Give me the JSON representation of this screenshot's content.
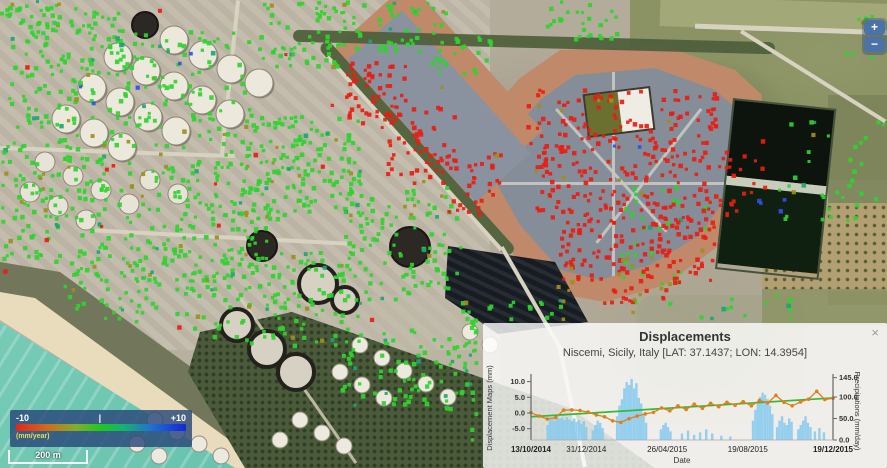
{
  "legend": {
    "min": "-10",
    "mid_tick": "|",
    "max": "+10",
    "units": "(mm/year)",
    "gradient": [
      "#e5261c 0%",
      "#d06a1e 18%",
      "#7fb02a 36%",
      "#1dc81d 50%",
      "#16b36e 63%",
      "#1e70d2 80%",
      "#1626d8 100%"
    ]
  },
  "scale_bar": {
    "label": "200 m"
  },
  "zoom_control": {
    "zoom_in": "+",
    "zoom_out": "−"
  },
  "popup": {
    "title": "Displacements",
    "subtitle": "Niscemi, Sicily, Italy [LAT: 37.1437; LON: 14.3954]",
    "close": "×"
  },
  "chart_data": {
    "type": "composite",
    "title": "Displacements",
    "subtitle": "Niscemi, Sicily, Italy [LAT: 37.1437; LON: 14.3954]",
    "x_axis": {
      "label": "Date",
      "tick_labels": [
        "13/10/2014",
        "31/12/2014",
        "26/04/2015",
        "19/08/2015",
        "19/12/2015"
      ],
      "tick_fracs": [
        0,
        0.183,
        0.451,
        0.718,
        1
      ]
    },
    "y_left": {
      "label": "Displacement Maps (mm)",
      "ticks": [
        10.0,
        5.0,
        0.0,
        -5.0
      ],
      "range": [
        -8.5,
        11.5
      ]
    },
    "y_right": {
      "label": "Precipitations (mm/day)",
      "ticks": [
        145.0,
        100.0,
        50.0,
        0.0
      ],
      "range": [
        0,
        160
      ]
    },
    "series": [
      {
        "name": "displacement",
        "type": "line",
        "color": "#e07f1e",
        "values": [
          0.1,
          -1.0,
          -1.9,
          -1.5,
          0.9,
          1.0,
          0.8,
          0.3,
          -0.6,
          -1.2,
          -2.5,
          -3.0,
          -1.8,
          -1.0,
          -0.3,
          0.2,
          1.6,
          0.7,
          2.3,
          1.1,
          2.8,
          1.5,
          3.1,
          2.0,
          3.4,
          2.5,
          3.6,
          2.3,
          4.0,
          3.2,
          5.6,
          3.4,
          2.3,
          3.5,
          4.4,
          6.9,
          4.3,
          4.7
        ]
      },
      {
        "name": "trend",
        "type": "line",
        "color": "#33bb33",
        "values": [
          -1.2,
          4.8
        ]
      },
      {
        "name": "precipitation",
        "type": "bar",
        "color": "#85c9ef",
        "points": [
          [
            0.055,
            35
          ],
          [
            0.063,
            48
          ],
          [
            0.071,
            52
          ],
          [
            0.079,
            45
          ],
          [
            0.087,
            55
          ],
          [
            0.095,
            50
          ],
          [
            0.103,
            52
          ],
          [
            0.111,
            47
          ],
          [
            0.119,
            53
          ],
          [
            0.127,
            48
          ],
          [
            0.135,
            44
          ],
          [
            0.143,
            50
          ],
          [
            0.151,
            42
          ],
          [
            0.159,
            46
          ],
          [
            0.167,
            38
          ],
          [
            0.175,
            44
          ],
          [
            0.183,
            30
          ],
          [
            0.205,
            22
          ],
          [
            0.213,
            35
          ],
          [
            0.221,
            45
          ],
          [
            0.229,
            40
          ],
          [
            0.237,
            28
          ],
          [
            0.285,
            55
          ],
          [
            0.293,
            80
          ],
          [
            0.301,
            95
          ],
          [
            0.309,
            120
          ],
          [
            0.317,
            135
          ],
          [
            0.325,
            128
          ],
          [
            0.333,
            142
          ],
          [
            0.341,
            120
          ],
          [
            0.349,
            132
          ],
          [
            0.357,
            98
          ],
          [
            0.365,
            85
          ],
          [
            0.373,
            60
          ],
          [
            0.381,
            40
          ],
          [
            0.43,
            25
          ],
          [
            0.438,
            35
          ],
          [
            0.446,
            40
          ],
          [
            0.454,
            30
          ],
          [
            0.462,
            20
          ],
          [
            0.5,
            15
          ],
          [
            0.52,
            22
          ],
          [
            0.54,
            12
          ],
          [
            0.56,
            18
          ],
          [
            0.58,
            25
          ],
          [
            0.6,
            15
          ],
          [
            0.63,
            10
          ],
          [
            0.66,
            8
          ],
          [
            0.735,
            45
          ],
          [
            0.743,
            70
          ],
          [
            0.751,
            85
          ],
          [
            0.759,
            100
          ],
          [
            0.767,
            110
          ],
          [
            0.775,
            105
          ],
          [
            0.783,
            95
          ],
          [
            0.791,
            80
          ],
          [
            0.799,
            60
          ],
          [
            0.815,
            30
          ],
          [
            0.823,
            45
          ],
          [
            0.831,
            55
          ],
          [
            0.839,
            40
          ],
          [
            0.847,
            35
          ],
          [
            0.855,
            50
          ],
          [
            0.863,
            42
          ],
          [
            0.885,
            25
          ],
          [
            0.893,
            35
          ],
          [
            0.901,
            45
          ],
          [
            0.909,
            55
          ],
          [
            0.917,
            40
          ],
          [
            0.925,
            30
          ],
          [
            0.94,
            20
          ],
          [
            0.955,
            28
          ],
          [
            0.97,
            18
          ]
        ]
      }
    ]
  },
  "map": {
    "markers": {
      "colors": {
        "green": "#2fd32f",
        "red": "#ea1c12",
        "olive": "#9c8f1c",
        "blue": "#2b50e8",
        "teal": "#1ba573"
      },
      "clusters": [
        [
          8,
          4,
          120,
          140,
          160,
          "green"
        ],
        [
          0,
          140,
          110,
          120,
          130,
          "green"
        ],
        [
          115,
          30,
          135,
          125,
          115,
          "green"
        ],
        [
          115,
          160,
          155,
          120,
          170,
          "green"
        ],
        [
          240,
          115,
          120,
          105,
          160,
          "green"
        ],
        [
          255,
          0,
          95,
          65,
          70,
          "green"
        ],
        [
          60,
          245,
          130,
          75,
          75,
          "green"
        ],
        [
          185,
          250,
          175,
          95,
          140,
          "green"
        ],
        [
          335,
          185,
          125,
          115,
          120,
          "green"
        ],
        [
          340,
          328,
          135,
          85,
          90,
          "green"
        ],
        [
          455,
          298,
          115,
          95,
          65,
          "green"
        ],
        [
          350,
          0,
          95,
          50,
          50,
          "green"
        ],
        [
          545,
          0,
          70,
          40,
          28,
          "green"
        ],
        [
          775,
          115,
          108,
          110,
          36,
          "green"
        ],
        [
          620,
          185,
          85,
          140,
          40,
          "green"
        ],
        [
          470,
          398,
          115,
          65,
          40,
          "green"
        ],
        [
          700,
          292,
          90,
          38,
          14,
          "green"
        ],
        [
          845,
          5,
          40,
          55,
          12,
          "green"
        ],
        [
          430,
          35,
          60,
          40,
          25,
          "green"
        ],
        [
          0,
          0,
          60,
          30,
          20,
          "green"
        ],
        [
          345,
          58,
          60,
          70,
          60,
          "red"
        ],
        [
          385,
          105,
          70,
          80,
          55,
          "red"
        ],
        [
          440,
          150,
          60,
          70,
          35,
          "red"
        ],
        [
          525,
          88,
          190,
          62,
          115,
          "red"
        ],
        [
          535,
          150,
          200,
          75,
          160,
          "red"
        ],
        [
          558,
          225,
          158,
          58,
          105,
          "red"
        ],
        [
          600,
          283,
          70,
          20,
          15,
          "red"
        ],
        [
          0,
          0,
          460,
          330,
          15,
          "red"
        ],
        [
          737,
          88,
          28,
          115,
          9,
          "red"
        ],
        [
          548,
          252,
          130,
          62,
          12,
          "olive"
        ],
        [
          380,
          70,
          300,
          180,
          14,
          "olive"
        ],
        [
          757,
          196,
          26,
          16,
          4,
          "blue"
        ],
        [
          70,
          15,
          150,
          90,
          5,
          "blue"
        ],
        [
          610,
          120,
          40,
          30,
          2,
          "blue"
        ]
      ]
    }
  }
}
